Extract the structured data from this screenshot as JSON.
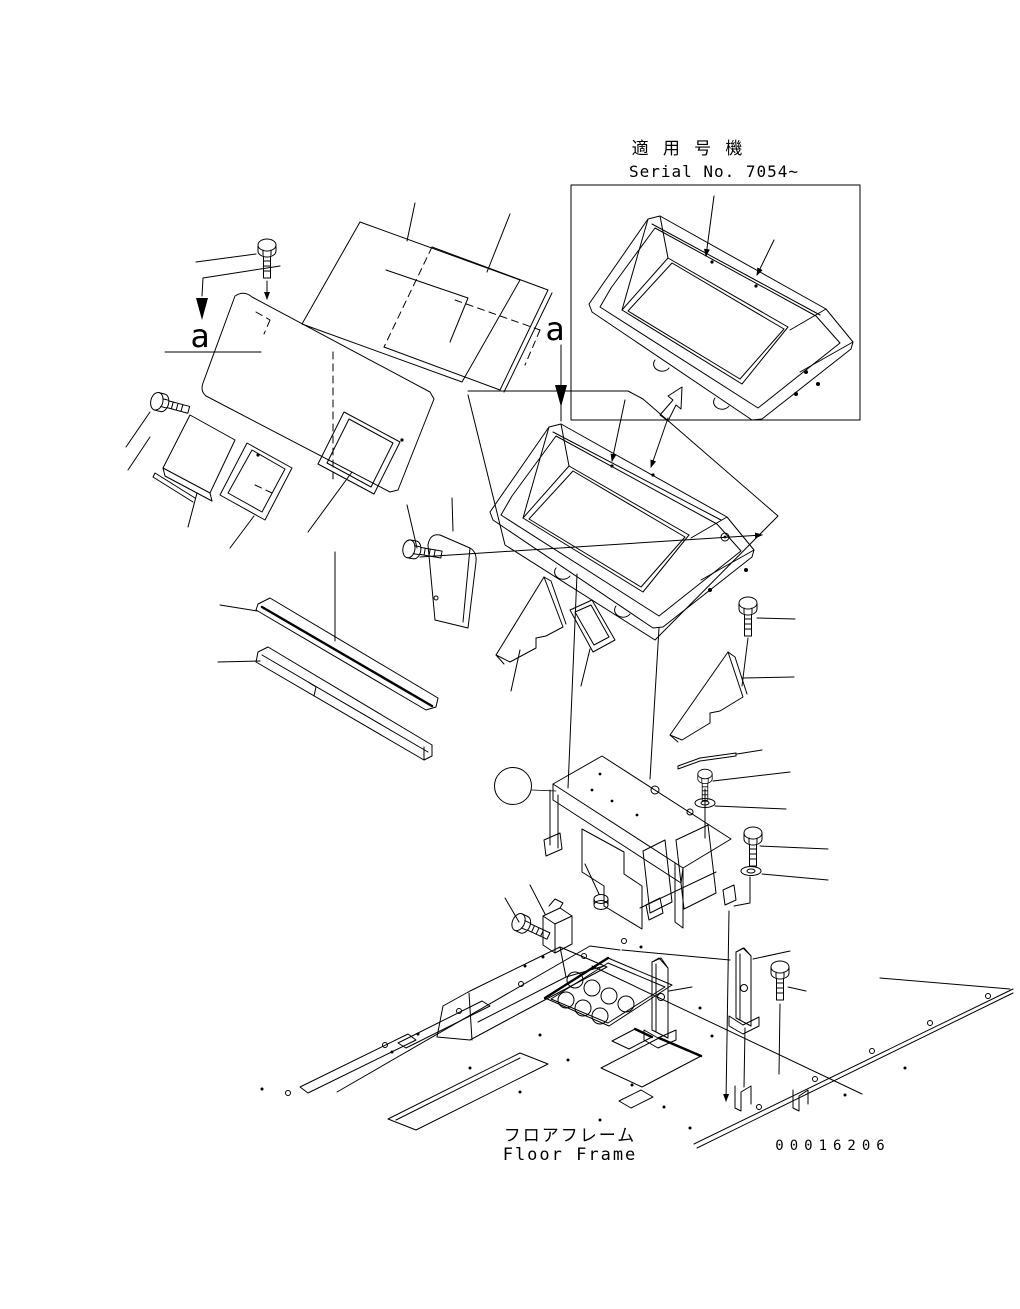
{
  "header": {
    "applicable_machines_jp": "適 用 号 機",
    "serial_no": "Serial No. 7054~"
  },
  "section_marks": {
    "left": "a",
    "right": "a"
  },
  "callout": {
    "number": "1",
    "fill_color": "#0a820a",
    "ring_color": "#000000",
    "number_color": "#ffffff"
  },
  "footer": {
    "frame_label_jp": "フロアフレーム",
    "frame_label_en": "Floor Frame",
    "drawing_number": "00016206"
  },
  "colors": {
    "line": "#000000",
    "background": "#ffffff"
  }
}
